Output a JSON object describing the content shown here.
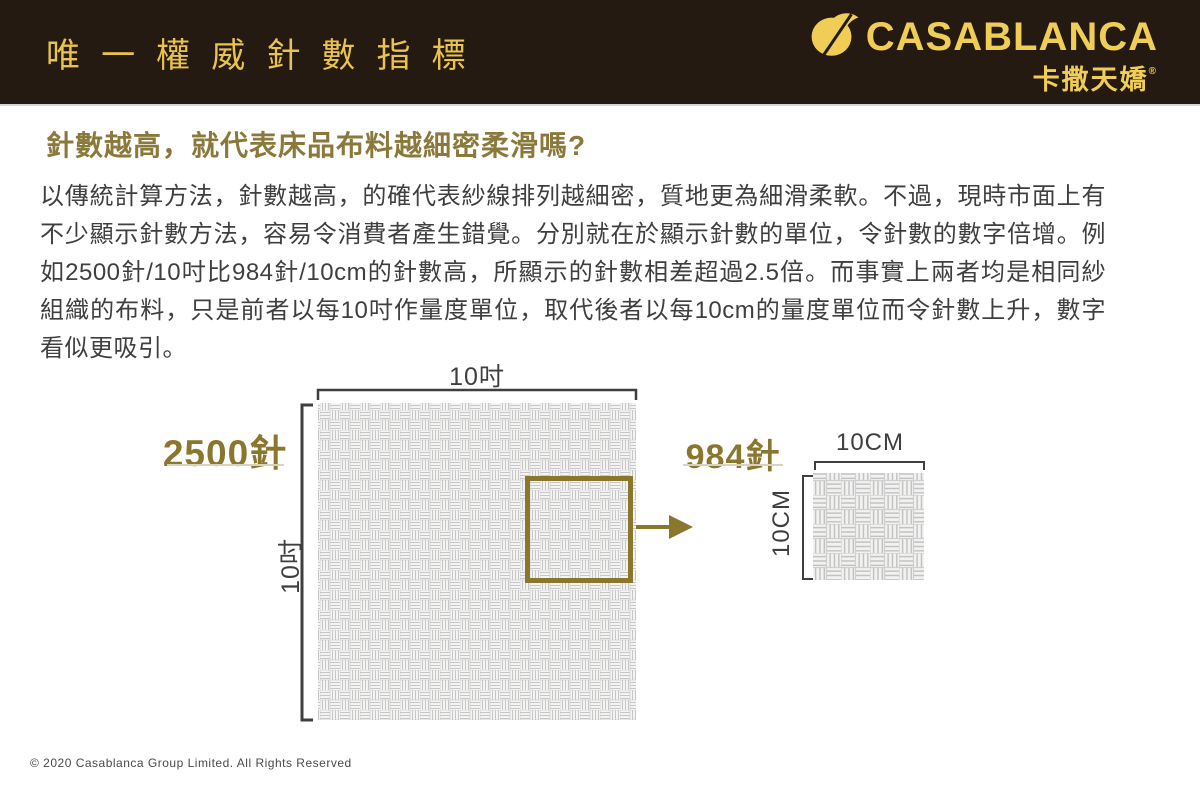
{
  "colors": {
    "header_bg": "#241a12",
    "header_gold": "#e9c34d",
    "logo_gold": "#f0cd55",
    "olive_gold": "#8b762e",
    "body_text": "#3f3f3f",
    "bracket": "#3f3f3f",
    "weave_line": "#c6c6c6",
    "weave_bg": "#f4f4f3"
  },
  "header": {
    "title": "唯一權威針數指標",
    "logo": {
      "brand": "CASABLANCA",
      "brand_cn": "卡撒天嬌",
      "registered": "®",
      "icon": "casablanca-yarn-needle-mark"
    }
  },
  "content": {
    "heading": "針數越高，就代表床品布料越細密柔滑嗎?",
    "paragraph_lines": [
      "以傳統計算方法，針數越高，的確代表紗線排列越細密，質地更為細滑柔軟。不過，現時市面上有",
      "不少顯示針數方法，容易令消費者產生錯覺。分別就在於顯示針數的單位，令針數的數字倍增。例",
      "如2500針/10吋比984針/10cm的針數高，所顯示的針數相差超過2.5倍。而事實上兩者均是相同紗線",
      "組織的布料，只是前者以每10吋作量度單位，取代後者以每10cm的量度單位而令針數上升，數字能",
      "看似更吸引。"
    ]
  },
  "diagram": {
    "large_swatch": {
      "stitch_count": "2500針",
      "width_label": "10吋",
      "height_label": "10吋"
    },
    "small_swatch": {
      "stitch_count": "984針",
      "width_label": "10CM",
      "height_label": "10CM"
    }
  },
  "footer": {
    "copyright": "© 2020  Casablanca Group Limited. All Rights Reserved"
  }
}
